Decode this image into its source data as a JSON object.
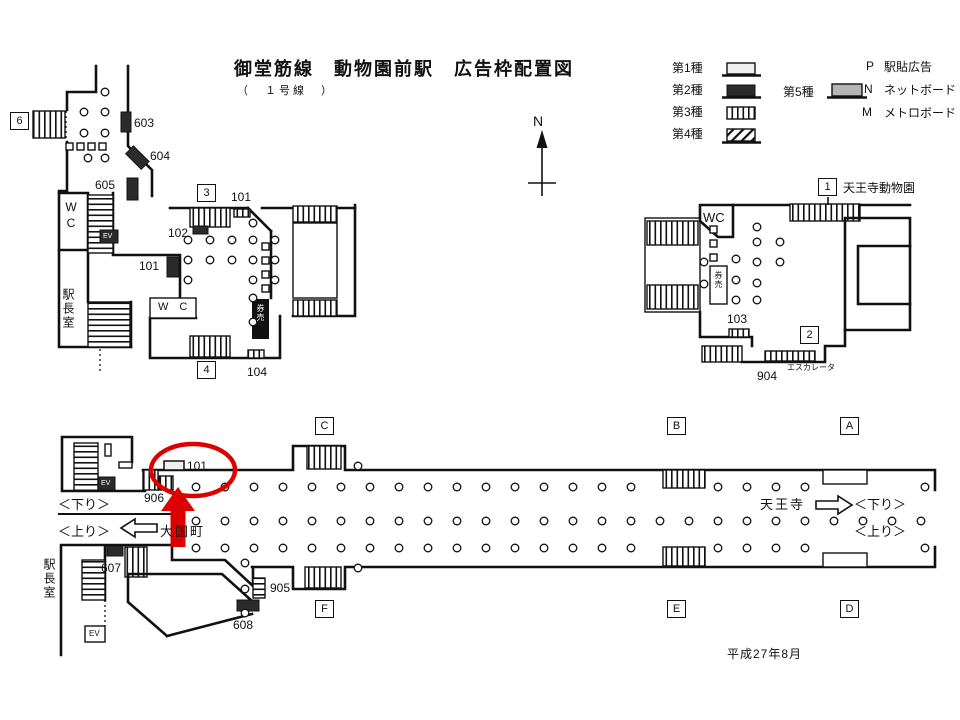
{
  "title": "御堂筋線　動物園前駅　広告枠配置図",
  "subtitle": "（　１号線　）",
  "compass": {
    "north": "N"
  },
  "legend": {
    "type1": "第1種",
    "type2": "第2種",
    "type3": "第3種",
    "type4": "第4種",
    "type5": "第5種",
    "p_key": "P",
    "p_label": "駅貼広告",
    "n_key": "N",
    "n_label": "ネットボード",
    "m_key": "M",
    "m_label": "メトロボード"
  },
  "colors": {
    "line": "#111111",
    "type1_fill": "#f0f0f0",
    "type2_fill": "#2b2b2b",
    "type5_fill": "#b5b5b5",
    "annotation_red": "#dd0000"
  },
  "concourse_left": {
    "exit6": "6",
    "exit3": "3",
    "exit4": "4",
    "wc_upper": "WC",
    "wc_mid": "W　C",
    "ev_upper": "EV",
    "office": "駅長室",
    "ticket": "券売",
    "ad603": "603",
    "ad604": "604",
    "ad605": "605",
    "ad101_top": "101",
    "ad102": "102",
    "ad101_mid": "101",
    "ad104": "104"
  },
  "concourse_right": {
    "exit1": "1",
    "exit2": "2",
    "dest": "天王寺動物園",
    "wc": "WC",
    "ticket": "券売",
    "ad103": "103",
    "ad904": "904",
    "escalator": "エスカレータ"
  },
  "platform": {
    "marker_a": "A",
    "marker_b": "B",
    "marker_c": "C",
    "marker_d": "D",
    "marker_e": "E",
    "marker_f": "F",
    "ad906": "906",
    "ad101": "101",
    "ad905": "905",
    "ad607": "607",
    "ad608": "608",
    "down_left": "＜下り＞",
    "up_left": "＜上り＞",
    "down_right": "＜下り＞",
    "up_right": "＜上り＞",
    "next_tennoji": "天王寺",
    "next_daikokucho": "大国町",
    "office": "駅長室",
    "ev_upper": "EV",
    "ev_lower": "EV"
  },
  "date": "平成27年8月"
}
